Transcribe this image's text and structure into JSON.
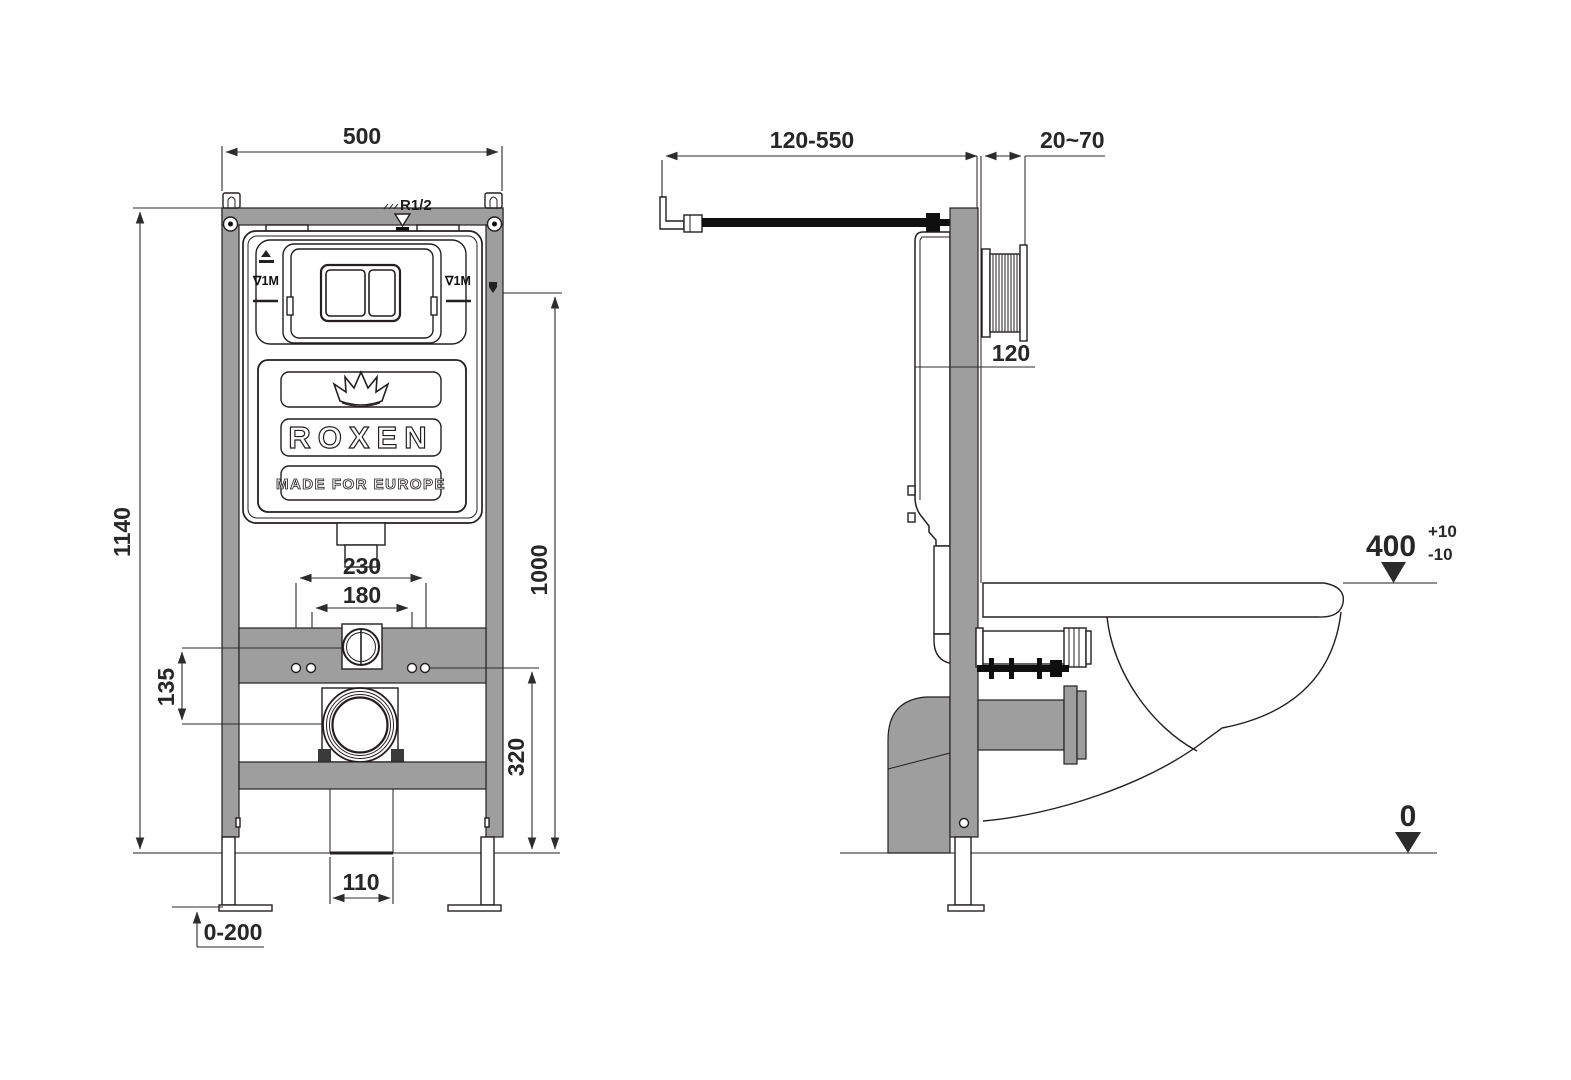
{
  "colors": {
    "frame_gray": "#9e9e9e",
    "line": "#231f20",
    "dim_text": "#272727",
    "background": "#fefefe"
  },
  "brand": {
    "logo": "ROXEN",
    "tagline": "MADE FOR EUROPE"
  },
  "front_view": {
    "dim_frame_width": "500",
    "dim_frame_height": "1140",
    "dim_inlet_thread": "R1/2",
    "level_mark_left": "∇1M",
    "level_mark_right": "∇1M",
    "dim_stud_spacing_outer": "230",
    "dim_stud_spacing_inner": "180",
    "dim_inlet_to_drain": "135",
    "dim_drain_height": "320",
    "dim_mark_height": "1000",
    "dim_outlet_width": "110",
    "dim_leg_adjust": "0-200"
  },
  "side_view": {
    "dim_supply_length": "120-550",
    "dim_wall_thickness": "20~70",
    "dim_cistern_depth": "120",
    "dim_rim_height": "400",
    "dim_rim_tol_plus": "+10",
    "dim_rim_tol_minus": "-10",
    "dim_floor_level": "0"
  }
}
